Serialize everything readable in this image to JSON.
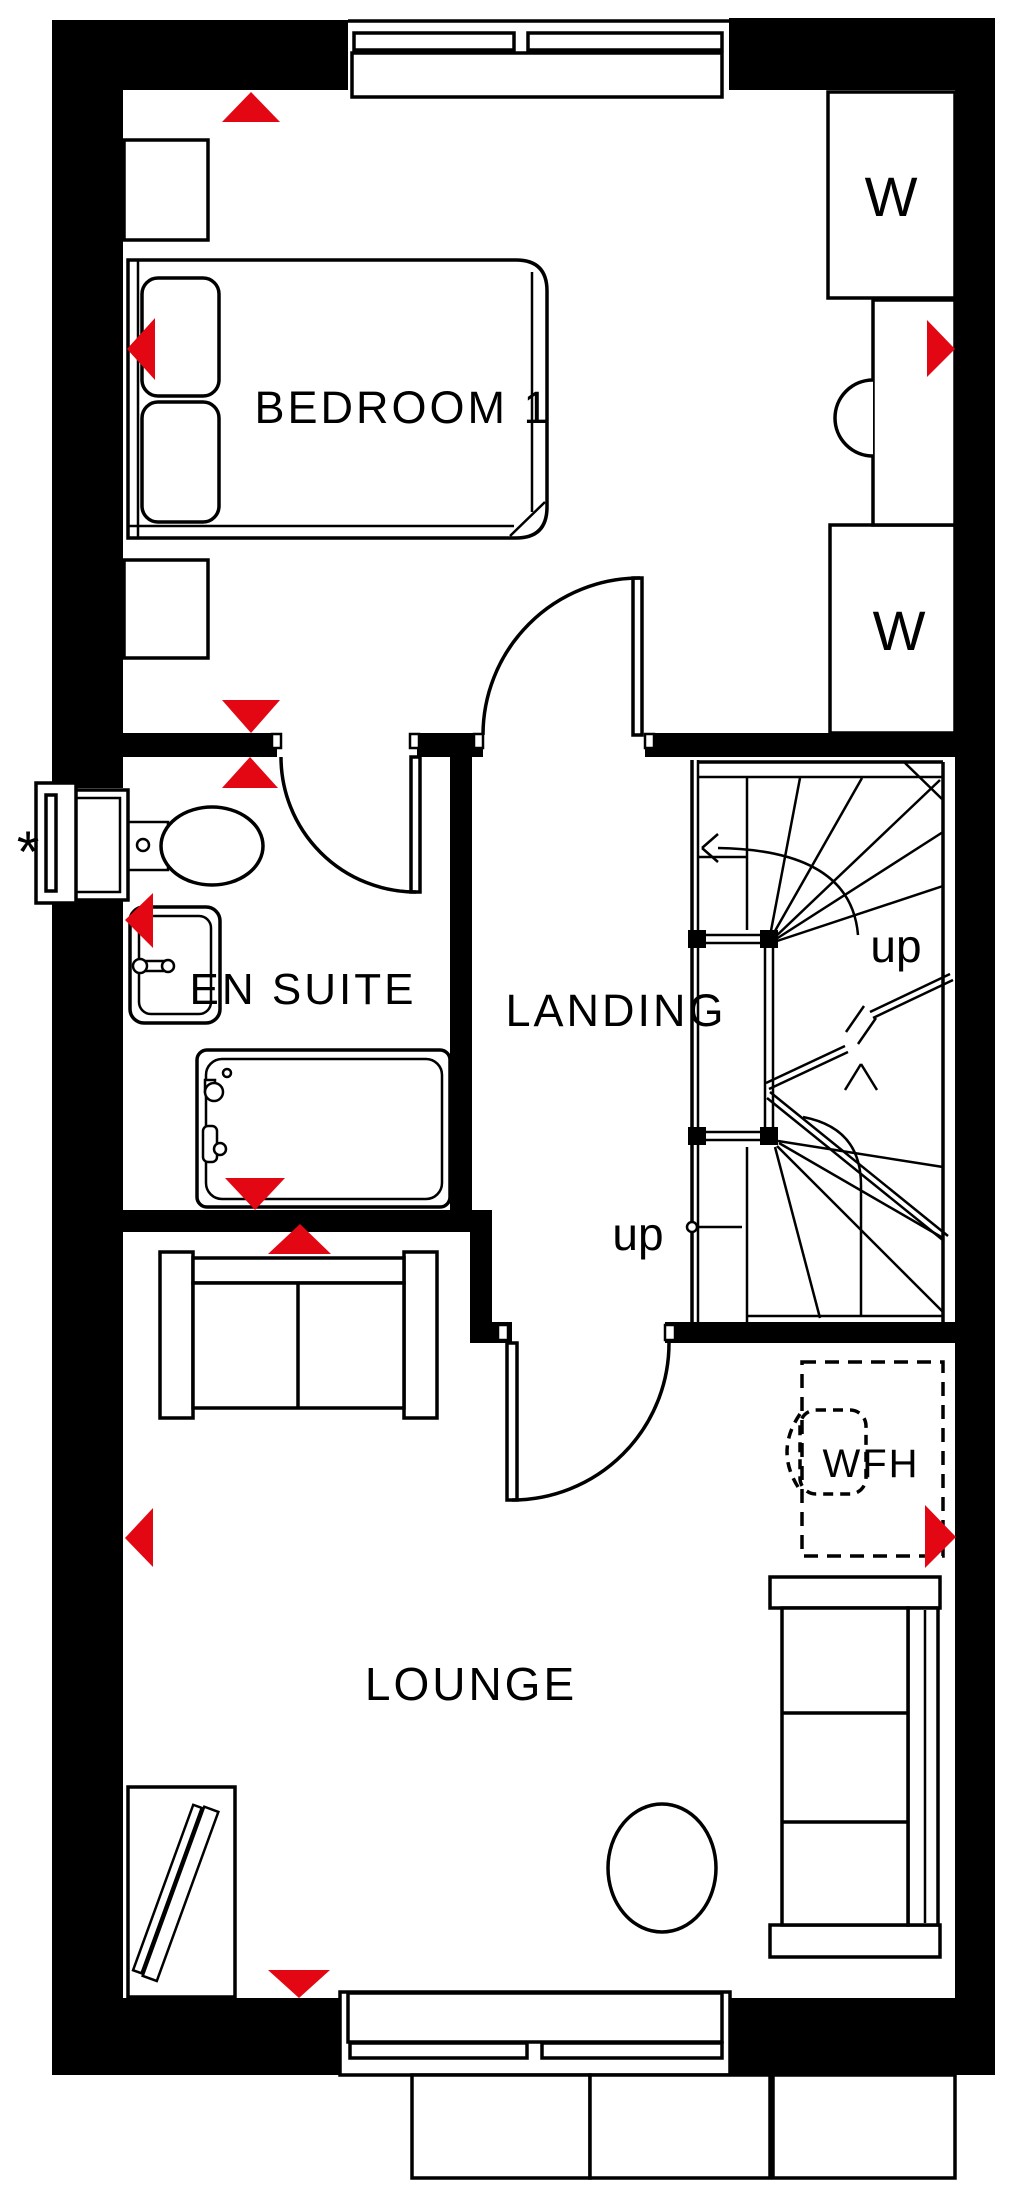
{
  "meta": {
    "figure_type": "floor-plan",
    "floor": "first floor"
  },
  "colors": {
    "background": "#ffffff",
    "wall": "#000000",
    "line": "#000000",
    "marker_red": "#e30613"
  },
  "rooms": [
    {
      "id": "bedroom-1",
      "label": "BEDROOM 1"
    },
    {
      "id": "en-suite",
      "label": "EN SUITE"
    },
    {
      "id": "landing",
      "label": "LANDING"
    },
    {
      "id": "lounge",
      "label": "LOUNGE"
    }
  ],
  "wardrobes": [
    {
      "label": "W"
    },
    {
      "label": "W"
    }
  ],
  "stairs": {
    "up_labels": [
      {
        "label": "up"
      },
      {
        "label": "up"
      }
    ]
  },
  "annotations": {
    "wfh_zone": "WFH",
    "window_note": "*"
  }
}
